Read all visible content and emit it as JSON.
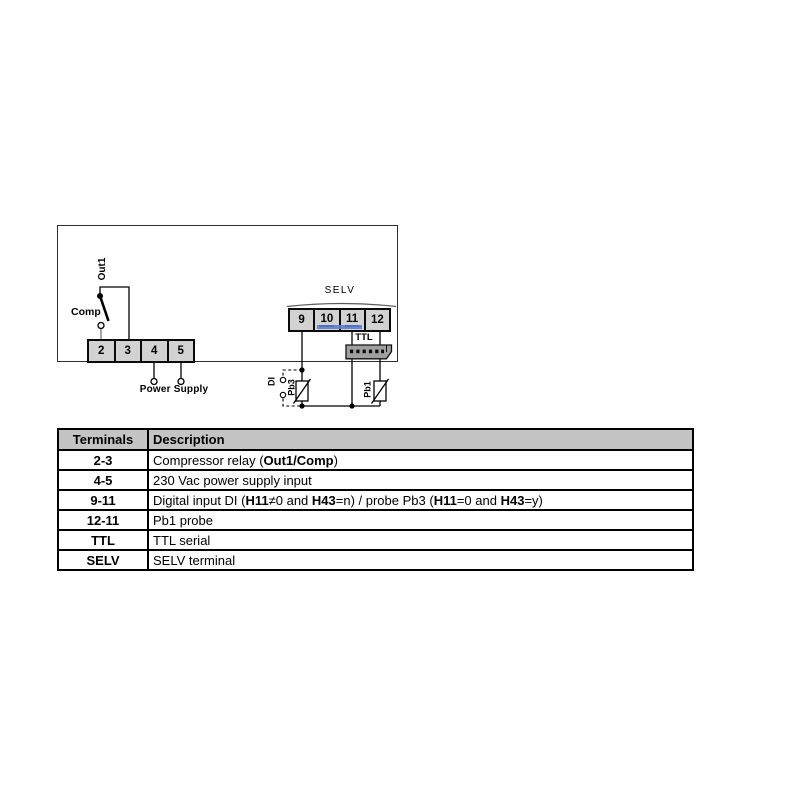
{
  "diagram": {
    "labels": {
      "out1": "Out1",
      "comp": "Comp",
      "power_supply": "Power Supply",
      "selv": "SELV",
      "ttl": "TTL",
      "di": "DI",
      "pb3": "Pb3",
      "pb1": "Pb1"
    },
    "left_terminals": [
      "2",
      "3",
      "4",
      "5"
    ],
    "right_terminals": [
      "9",
      "10",
      "11",
      "12"
    ],
    "underlined_terminals": [
      "10",
      "11"
    ]
  },
  "colors": {
    "terminal-fill": "#d2d2d2",
    "highlight-blue": "#5b7ed0",
    "connector-gray": "#a0a0a0",
    "header-gray": "#c4c4c4"
  },
  "table": {
    "headers": [
      "Terminals",
      "Description"
    ],
    "rows": [
      {
        "terminal": "2-3",
        "description": [
          {
            "text": "Compressor relay ("
          },
          {
            "text": "Out1/Comp",
            "bold": true
          },
          {
            "text": ")"
          }
        ]
      },
      {
        "terminal": "4-5",
        "description": [
          {
            "text": "230 Vac power supply input"
          }
        ]
      },
      {
        "terminal": "9-11",
        "description": [
          {
            "text": "Digital input DI ("
          },
          {
            "text": "H11",
            "bold": true
          },
          {
            "text": "≠0 and "
          },
          {
            "text": "H43",
            "bold": true
          },
          {
            "text": "=n) / probe Pb3 ("
          },
          {
            "text": "H11",
            "bold": true
          },
          {
            "text": "=0 and "
          },
          {
            "text": "H43",
            "bold": true
          },
          {
            "text": "=y)"
          }
        ]
      },
      {
        "terminal": "12-11",
        "description": [
          {
            "text": "Pb1 probe"
          }
        ]
      },
      {
        "terminal": "TTL",
        "description": [
          {
            "text": "TTL serial"
          }
        ]
      },
      {
        "terminal": "SELV",
        "description": [
          {
            "text": "SELV terminal"
          }
        ]
      }
    ]
  }
}
